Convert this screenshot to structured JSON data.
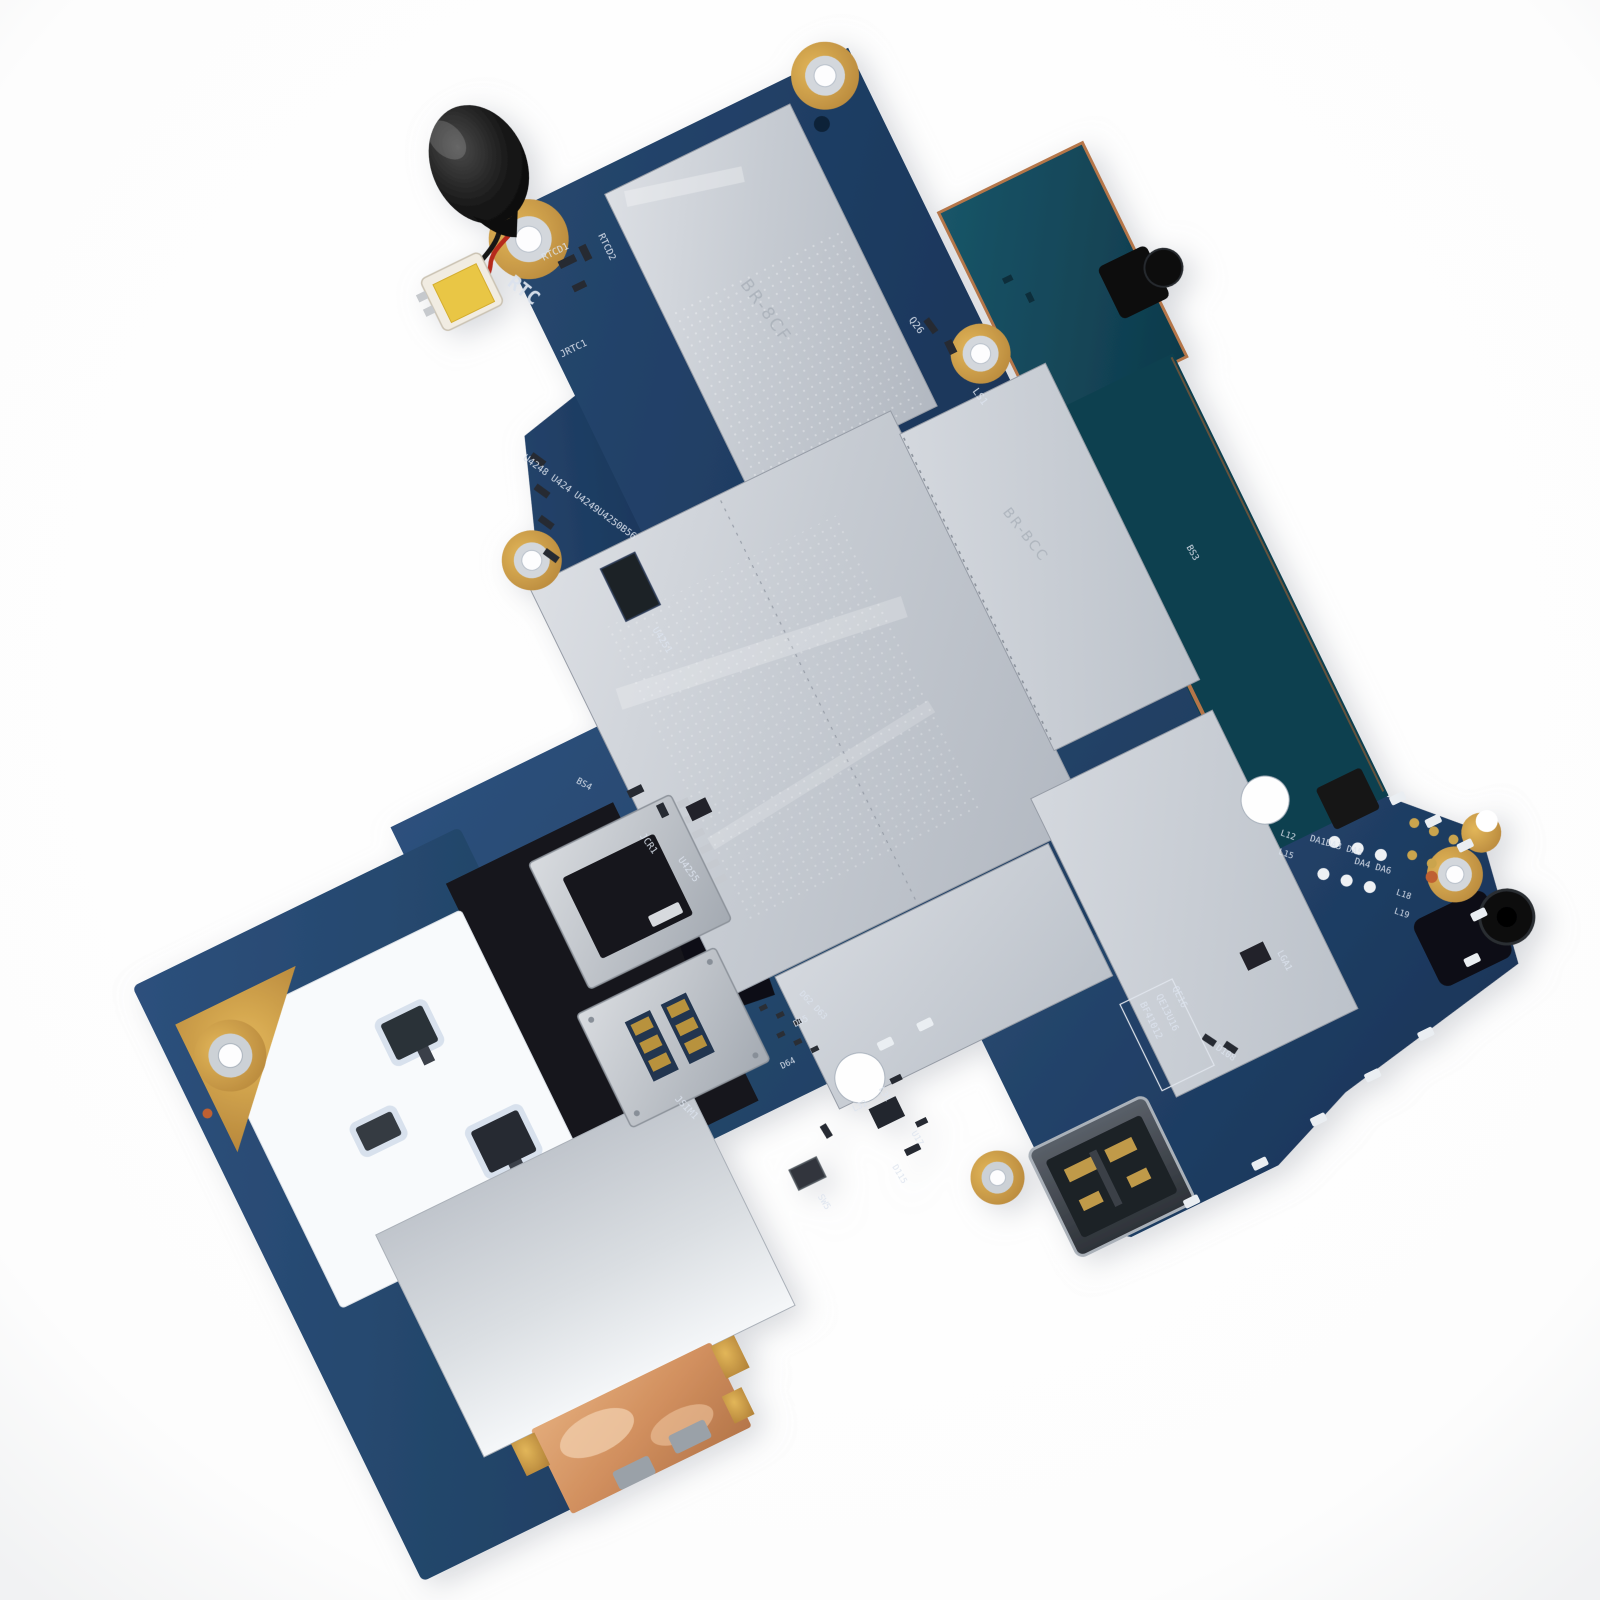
{
  "photo": {
    "subject": "Tablet motherboard logic board photographed on a white background, rotated counter-clockwise",
    "background_color": "#ffffff"
  },
  "colors": {
    "pcb_navy": "#1f3f6a",
    "pcb_teal": "#155064",
    "emi_shield_silver": "#c9cdd4",
    "copper_trim": "#b5764a",
    "dock_copper": "#d99e6e",
    "gold_pad": "#c9984a",
    "battery_black": "#121212",
    "wire_red": "#b5291f",
    "wire_black": "#141414",
    "connector_tape_yellow": "#e9c645",
    "sticker_white": "#f8fafc"
  },
  "silkscreen": {
    "rtc": "RTC",
    "rtcd1": "RTCD1",
    "rtcd2": "RTCD2",
    "jrtc1": "JRTC1",
    "u4248_row": "U4248 U424 U4249U4250B56",
    "u4251": "U4251",
    "q26": "Q26",
    "ls1": "LS1",
    "bs3": "BS3",
    "bs4": "BS4",
    "jcr1": "JCR1",
    "u4255": "U4255",
    "jsim1": "JSIM1",
    "d62_d63": "D62 D63",
    "d65": "D65",
    "d64": "D64",
    "l12": "L12",
    "l15": "L15",
    "da_row_1": "DA1DA3 DA5",
    "da_row_2": "DA4 DA6",
    "l18": "L18",
    "l19": "L19",
    "lga1": "LGA1",
    "d108": "D108",
    "l31": "L31",
    "l32": "L32",
    "u17": "U17",
    "d115": "D115",
    "sw5": "SW5",
    "box_label_line1": "BF41012",
    "box_label_line2": "QE13U16",
    "box_label_line3": "QE16"
  },
  "shield_etch": {
    "top_shield": "BR-8CF",
    "right_shield": "BR-BCC"
  },
  "parts": {
    "battery": "rtc-coin-cell-battery",
    "card_slot": "microsd-card-slot",
    "sim": "sim-card-slot",
    "usb": "usb-port",
    "audio": "audio-jack",
    "dock": "dock-connector-copper"
  }
}
